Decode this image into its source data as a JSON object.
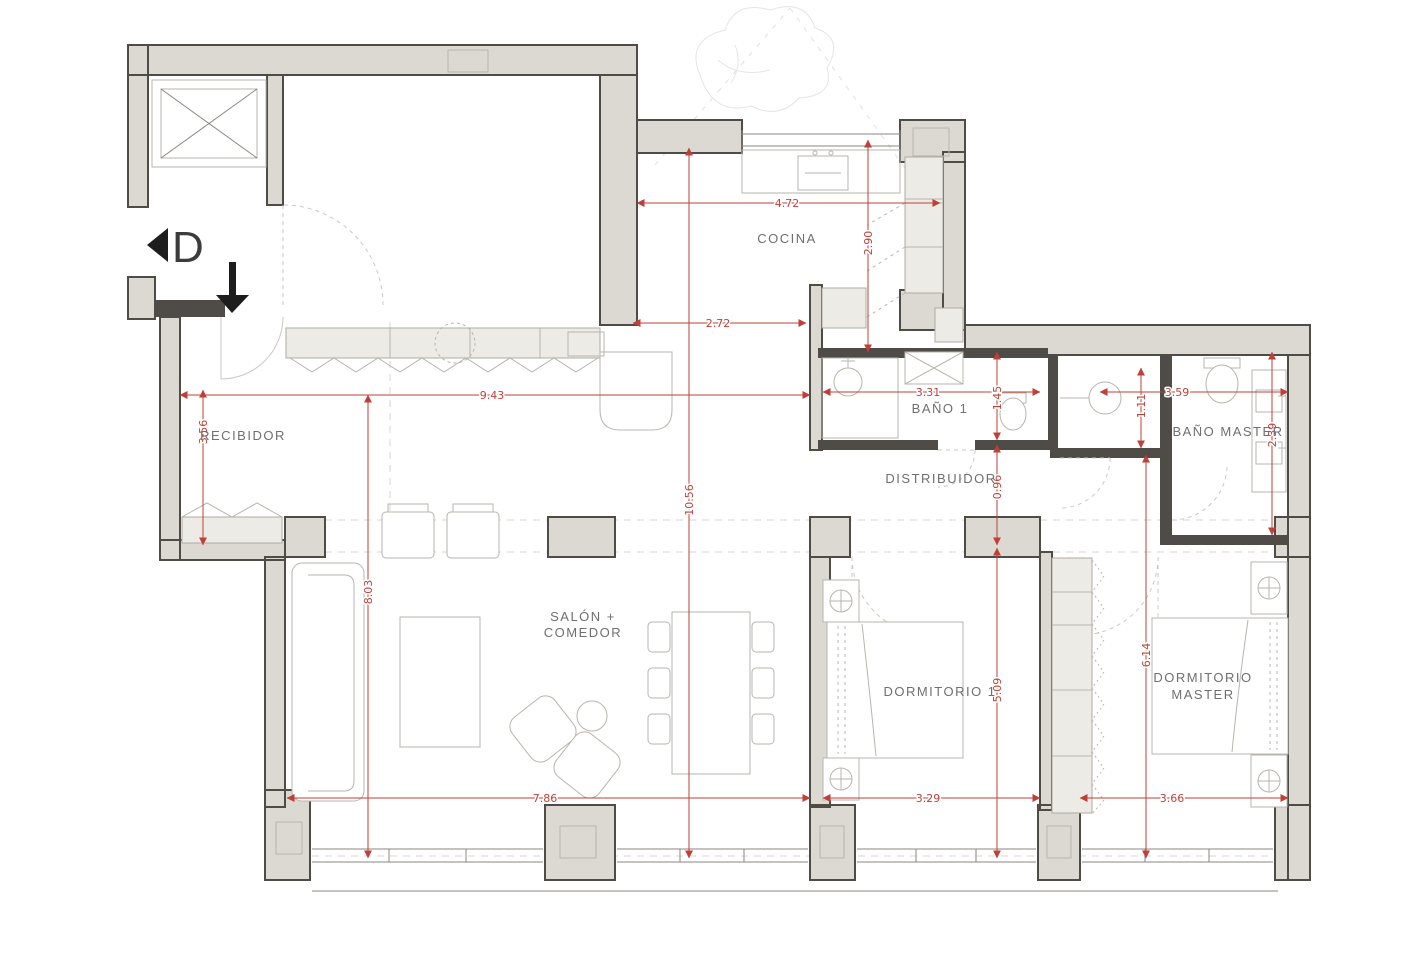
{
  "plan": {
    "title": "apartment-floor-plan",
    "colors": {
      "background": "#ffffff",
      "wall_fill": "#dcd9d2",
      "wall_stroke": "#4f4c47",
      "furniture_stroke": "#b8b5ad",
      "cabinet_fill": "#edebe6",
      "dimension_red": "#bf4038",
      "label_gray": "#6e6f71"
    },
    "rooms": {
      "cocina": {
        "label": "COCINA"
      },
      "recibidor": {
        "label": "RECIBIDOR"
      },
      "bano1": {
        "label": "BAÑO 1"
      },
      "bano_master": {
        "label": "BAÑO MASTER"
      },
      "distribuidor": {
        "label": "DISTRIBUIDOR"
      },
      "salon_comedor": {
        "label_line1": "SALÓN +",
        "label_line2": "COMEDOR"
      },
      "dormitorio1": {
        "label": "DORMITORIO 1"
      },
      "dormitorio_master": {
        "label_line1": "DORMITORIO",
        "label_line2": "MASTER"
      }
    },
    "dimensions": {
      "kitchen_width": "4.72",
      "kitchen_depth": "2.90",
      "kitchen_pass": "2.72",
      "living_span": "9.43",
      "recibidor_height": "3.56",
      "bano1_width": "3.31",
      "bano1_depth": "1.45",
      "bano_master_width": "3.59",
      "shower_depth": "1.11",
      "bano_master_depth": "2.39",
      "distribuidor_width": "0.96",
      "total_depth": "10.56",
      "salon_height": "8.03",
      "salon_width": "7.86",
      "dorm1_width": "3.29",
      "dorm1_height": "5.09",
      "dorm_master_width": "3.66",
      "dorm_master_height": "6.14"
    },
    "markers": {
      "entry_letter": "D"
    }
  }
}
